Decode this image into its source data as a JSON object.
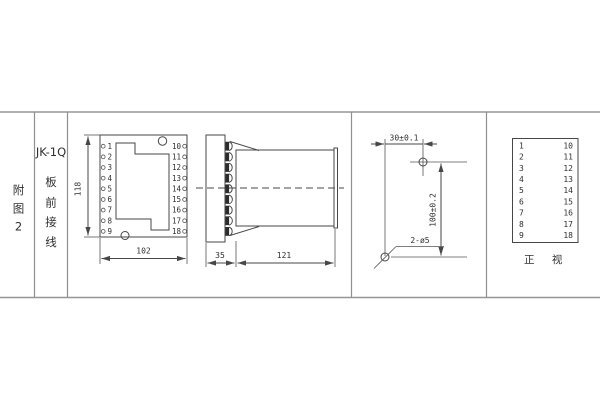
{
  "colors": {
    "line": "#474747",
    "frame": "#969696",
    "background": "#ffffff",
    "text": "#2f2f2f"
  },
  "sidebar": {
    "figure_label_chars": [
      "附",
      "图",
      "2"
    ],
    "model": "JK-1Q",
    "wiring_label_chars": [
      "板",
      "前",
      "接",
      "线"
    ]
  },
  "front_view": {
    "left_terminals": [
      "1",
      "2",
      "3",
      "4",
      "5",
      "6",
      "7",
      "8",
      "9"
    ],
    "right_terminals": [
      "10",
      "11",
      "12",
      "13",
      "14",
      "15",
      "16",
      "17",
      "18"
    ],
    "dim_height": "118",
    "dim_width": "102"
  },
  "side_view": {
    "dim_plate_depth": "35",
    "dim_body_depth": "121"
  },
  "drill_plan": {
    "dim_horizontal": "30±0.1",
    "dim_vertical": "100±0.2",
    "hole_note": "2-ø5"
  },
  "terminal_table": {
    "left": [
      "1",
      "2",
      "3",
      "4",
      "5",
      "6",
      "7",
      "8",
      "9"
    ],
    "right": [
      "10",
      "11",
      "12",
      "13",
      "14",
      "15",
      "16",
      "17",
      "18"
    ],
    "caption": "正 视"
  }
}
